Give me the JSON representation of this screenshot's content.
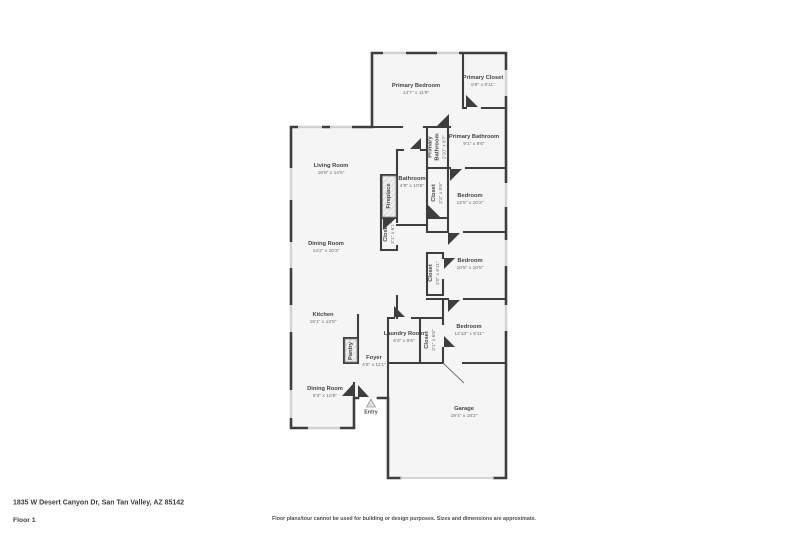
{
  "plan": {
    "rooms": [
      {
        "name": "Primary Bedroom",
        "dims": "14'7\" x 11'9\"",
        "x": 416,
        "y": 89,
        "rotate": false
      },
      {
        "name": "Primary Closet",
        "dims": "6'8\" x 8'11\"",
        "x": 483,
        "y": 81,
        "rotate": false
      },
      {
        "name": "Primary Bathroom",
        "dims": "9'1\" x 9'6\"",
        "x": 474,
        "y": 140,
        "rotate": false
      },
      {
        "name": "Primary Bathroom",
        "dims": "2'10\" x 8'7\"",
        "x": 437,
        "y": 147,
        "rotate": true
      },
      {
        "name": "Living Room",
        "dims": "16'8\" x 14'5\"",
        "x": 331,
        "y": 169,
        "rotate": false
      },
      {
        "name": "Bathroom",
        "dims": "4'9\" x 10'5\"",
        "x": 412,
        "y": 182,
        "rotate": false
      },
      {
        "name": "Closet",
        "dims": "2'3\" x 5'6\"",
        "x": 437,
        "y": 193,
        "rotate": true
      },
      {
        "name": "Bedroom",
        "dims": "12'5\" x 10'2\"",
        "x": 470,
        "y": 199,
        "rotate": false
      },
      {
        "name": "Fireplace",
        "dims": "",
        "x": 389,
        "y": 196,
        "rotate": true
      },
      {
        "name": "Closet",
        "dims": "2'1\" x 6'1\"",
        "x": 389,
        "y": 233,
        "rotate": true
      },
      {
        "name": "Dining Room",
        "dims": "14'2\" x 10'3\"",
        "x": 326,
        "y": 247,
        "rotate": false
      },
      {
        "name": "Bedroom",
        "dims": "10'5\" x 10'5\"",
        "x": 470,
        "y": 264,
        "rotate": false
      },
      {
        "name": "Closet",
        "dims": "2'0\" x 6'11\"",
        "x": 434,
        "y": 273,
        "rotate": true
      },
      {
        "name": "Kitchen",
        "dims": "16'1\" x 13'8\"",
        "x": 323,
        "y": 318,
        "rotate": false
      },
      {
        "name": "Bedroom",
        "dims": "12'10\" x 9'11\"",
        "x": 469,
        "y": 330,
        "rotate": false
      },
      {
        "name": "Laundry Room",
        "dims": "6'2\" x 6'6\"",
        "x": 404,
        "y": 337,
        "rotate": false
      },
      {
        "name": "Closet",
        "dims": "2'1\" x 6'6\"",
        "x": 430,
        "y": 340,
        "rotate": true
      },
      {
        "name": "Pantry",
        "dims": "",
        "x": 351,
        "y": 351,
        "rotate": true
      },
      {
        "name": "Foyer",
        "dims": "4'5\" x 11'1\"",
        "x": 374,
        "y": 361,
        "rotate": false
      },
      {
        "name": "Dining Room",
        "dims": "9'3\" x 10'8\"",
        "x": 325,
        "y": 392,
        "rotate": false
      },
      {
        "name": "Garage",
        "dims": "19'4\" x 19'2\"",
        "x": 464,
        "y": 412,
        "rotate": false
      }
    ],
    "entry_label": "Entry"
  },
  "footer": {
    "address": "1835 W Desert Canyon Dr, San Tan Valley, AZ 85142",
    "floor_label": "Floor 1",
    "disclaimer": "Floor plans/tour cannot be used for building or design purposes. Sizes and dimensions are approximate."
  },
  "colors": {
    "wall": "#3e3e3e",
    "floor": "#f5f5f5",
    "window": "#ebebeb",
    "hatch": "#c9c9c9"
  }
}
